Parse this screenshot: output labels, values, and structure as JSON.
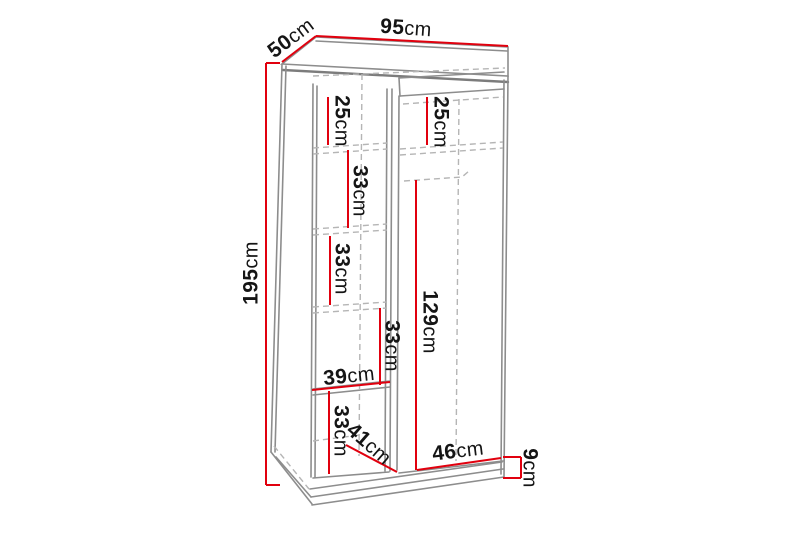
{
  "diagram": {
    "unit": "cm",
    "colors": {
      "dimension_red": "#e1000e",
      "outline_gray": "#8d8d8d",
      "hidden_edge_gray": "#b5b5b5",
      "label_black": "#151515",
      "background": "#ffffff"
    },
    "labels": [
      {
        "name": "depth-top",
        "value": "50",
        "unit": "cm"
      },
      {
        "name": "width-top",
        "value": "95",
        "unit": "cm"
      },
      {
        "name": "height-left",
        "value": "195",
        "unit": "cm"
      },
      {
        "name": "left-column-top-section",
        "value": "25",
        "unit": "cm"
      },
      {
        "name": "right-column-top-section",
        "value": "25",
        "unit": "cm"
      },
      {
        "name": "left-column-section-2",
        "value": "33",
        "unit": "cm"
      },
      {
        "name": "left-column-section-3",
        "value": "33",
        "unit": "cm"
      },
      {
        "name": "left-column-section-4",
        "value": "33",
        "unit": "cm"
      },
      {
        "name": "hanging-space-height",
        "value": "129",
        "unit": "cm"
      },
      {
        "name": "left-column-width",
        "value": "39",
        "unit": "cm"
      },
      {
        "name": "left-column-bottom-section",
        "value": "33",
        "unit": "cm"
      },
      {
        "name": "bottom-shelf-depth",
        "value": "41",
        "unit": "cm"
      },
      {
        "name": "right-column-width",
        "value": "46",
        "unit": "cm"
      },
      {
        "name": "plinth-height",
        "value": "9",
        "unit": "cm"
      }
    ]
  }
}
